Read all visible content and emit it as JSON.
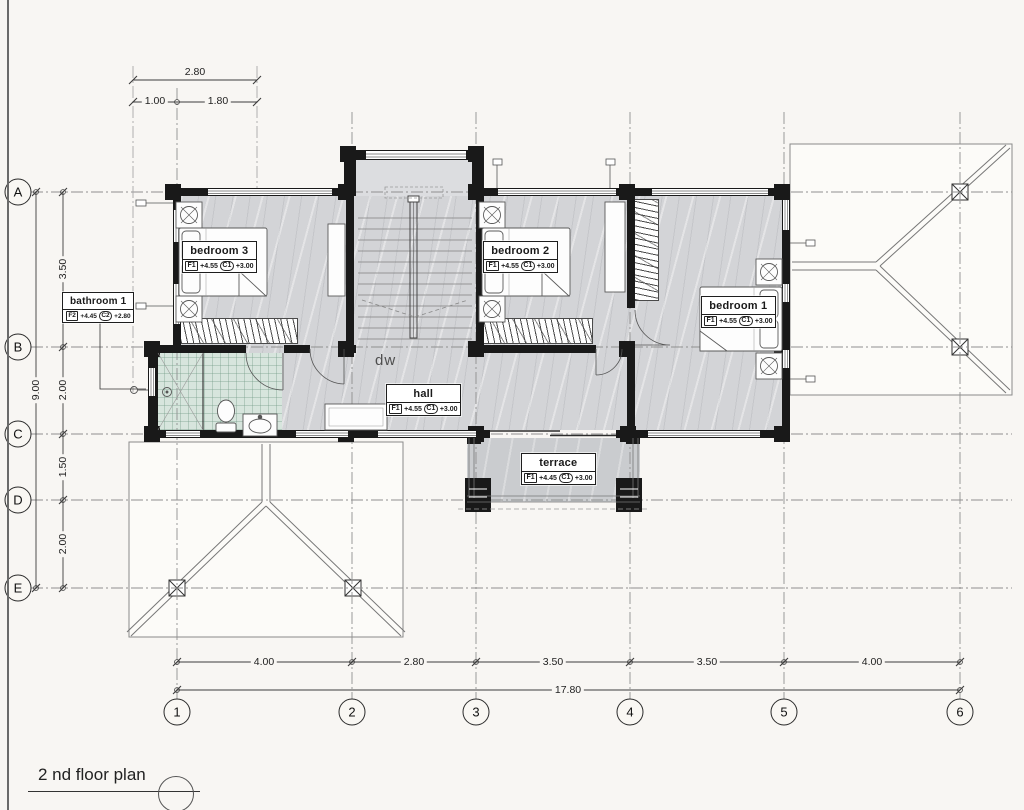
{
  "page": {
    "title": "2 nd floor plan"
  },
  "colors": {
    "wall": "#191919",
    "floor": "#d3d4d7",
    "bath_tile": "#d7e5dd",
    "terrace": "#cacccf",
    "line": "#707070",
    "background": "#f8f6f3"
  },
  "grid": {
    "columns": [
      "1",
      "2",
      "3",
      "4",
      "5",
      "6"
    ],
    "rows": [
      "A",
      "B",
      "C",
      "D",
      "E"
    ]
  },
  "dims": {
    "top_total": "2.80",
    "top_segments": [
      "1.00",
      "1.80"
    ],
    "bottom_segments": [
      "4.00",
      "2.80",
      "3.50",
      "3.50",
      "4.00"
    ],
    "bottom_total": "17.80",
    "left_segments": [
      "3.50",
      "2.00",
      "1.50",
      "2.00"
    ],
    "left_total": "9.00"
  },
  "rooms": [
    {
      "name": "bedroom 3",
      "f_tag": "F1",
      "f_val": "+4.55",
      "c_tag": "C1",
      "c_val": "+3.00"
    },
    {
      "name": "bedroom 2",
      "f_tag": "F1",
      "f_val": "+4.55",
      "c_tag": "C1",
      "c_val": "+3.00"
    },
    {
      "name": "bedroom 1",
      "f_tag": "F1",
      "f_val": "+4.55",
      "c_tag": "C1",
      "c_val": "+3.00"
    },
    {
      "name": "bathroom 1",
      "f_tag": "F2",
      "f_val": "+4.45",
      "c_tag": "C2",
      "c_val": "+2.80"
    },
    {
      "name": "hall",
      "f_tag": "F1",
      "f_val": "+4.55",
      "c_tag": "C1",
      "c_val": "+3.00"
    },
    {
      "name": "terrace",
      "f_tag": "F1",
      "f_val": "+4.45",
      "c_tag": "C1",
      "c_val": "+3.00"
    }
  ],
  "annotations": {
    "stair": "dw"
  }
}
